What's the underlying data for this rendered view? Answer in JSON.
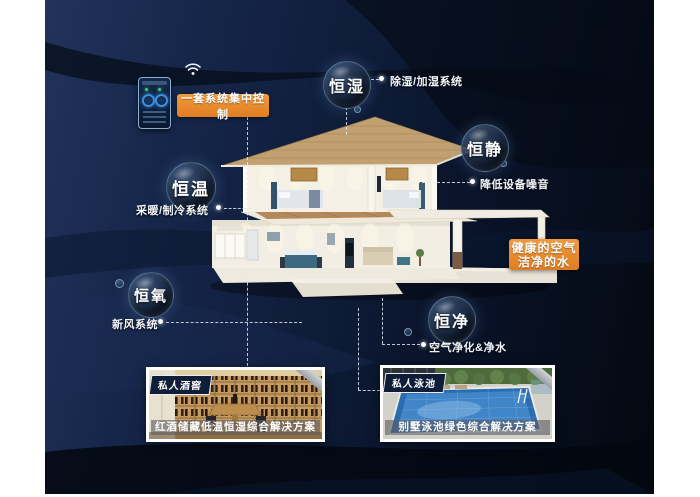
{
  "poster": {
    "theme": "smart-home-constant-systems"
  },
  "colors": {
    "accent_orange": "#E8862B",
    "background_navy": "#0E1C38",
    "bubble_ring_blue": "#9FC6E6",
    "text_white": "#FFFFFF"
  },
  "controller": {
    "label": "一套系统集中控制",
    "device": "wall-mounted smart control panel",
    "wifi_icon": "wifi-icon"
  },
  "features": [
    {
      "name": "恒湿",
      "note": "除湿/加湿系统"
    },
    {
      "name": "恒静",
      "note": "降低设备噪音"
    },
    {
      "name": "恒温",
      "note": "采暖/制冷系统"
    },
    {
      "name": "恒氧",
      "note": "新风系统"
    },
    {
      "name": "恒净",
      "note": "空气净化&净水"
    }
  ],
  "highlight": {
    "line1": "健康的空气",
    "line2": "洁净的水"
  },
  "cards": [
    {
      "badge": "私人酒窖",
      "caption": "红酒储藏低温恒湿综合解决方案"
    },
    {
      "badge": "私人泳池",
      "caption": "别墅泳池绿色综合解决方案"
    }
  ]
}
